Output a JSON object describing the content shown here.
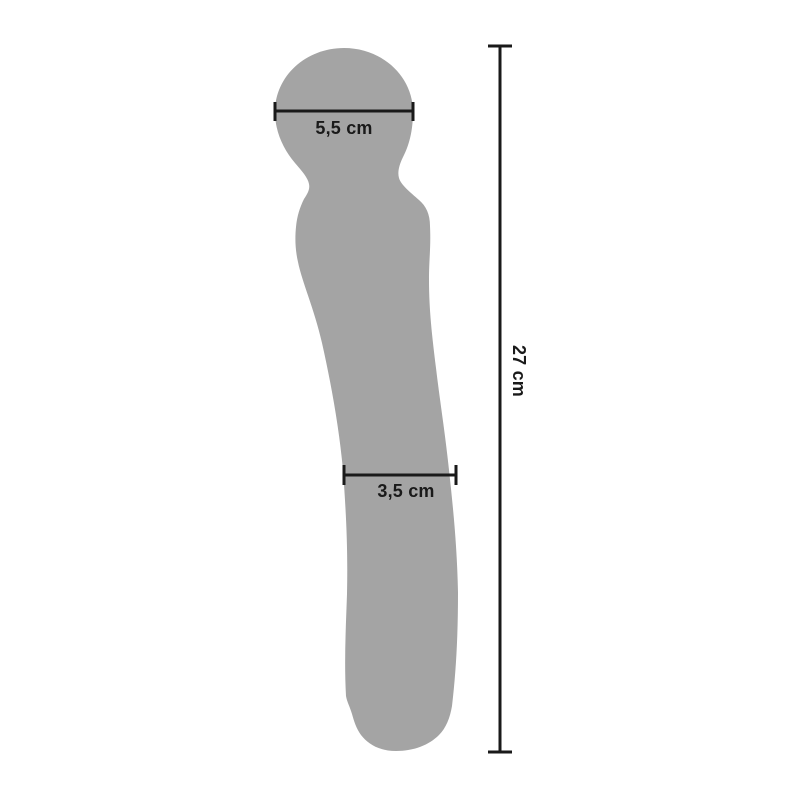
{
  "diagram": {
    "kind": "product-dimensions-diagram",
    "object_name": "wand-massager-silhouette",
    "colors": {
      "background": "#ffffff",
      "silhouette": "#a4a4a4",
      "lines_and_text": "#1a1a1a"
    },
    "measurements": {
      "head_width": "5,5 cm",
      "shaft_width": "3,5 cm",
      "total_length": "27 cm"
    }
  }
}
